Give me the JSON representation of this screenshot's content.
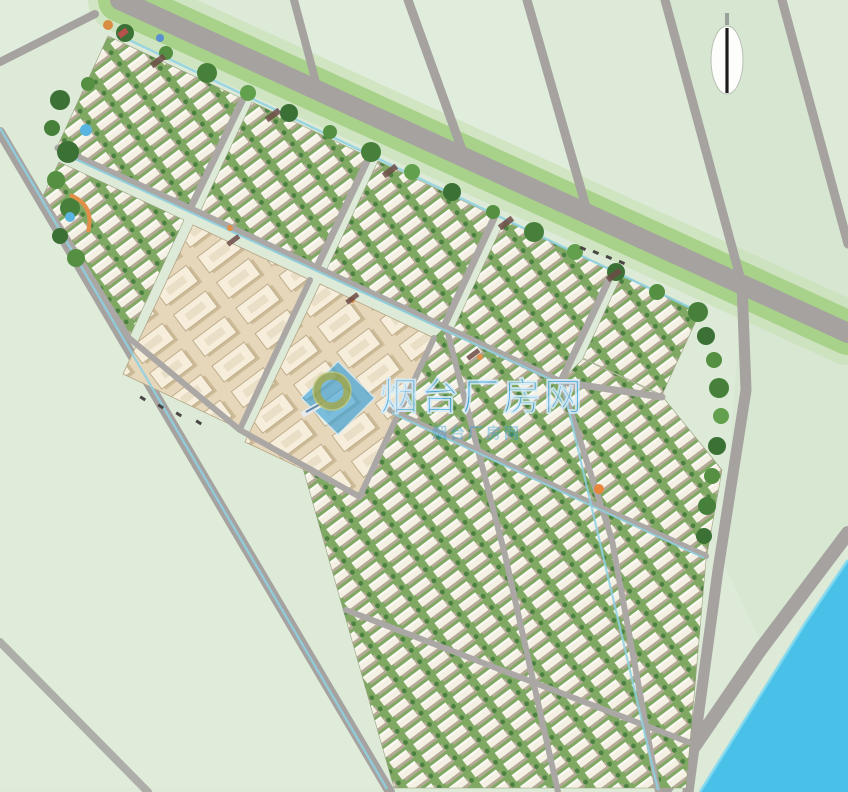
{
  "watermark": {
    "text": "烟台厂房网",
    "faint_text": "烟台厂房网",
    "color": "#2b9cda"
  },
  "colors": {
    "field": "#dcead7",
    "field_light": "#e2eedd",
    "field_dark": "#d2e3cc",
    "road": "#a5a2a0",
    "verge": "#a8d189",
    "tree": "#3c7136",
    "water": "#49c0e8",
    "canal": "#8ed2e2",
    "building": "#f4f1e4",
    "beige_building": "#f6eedb",
    "block_green": "#7fa963"
  }
}
